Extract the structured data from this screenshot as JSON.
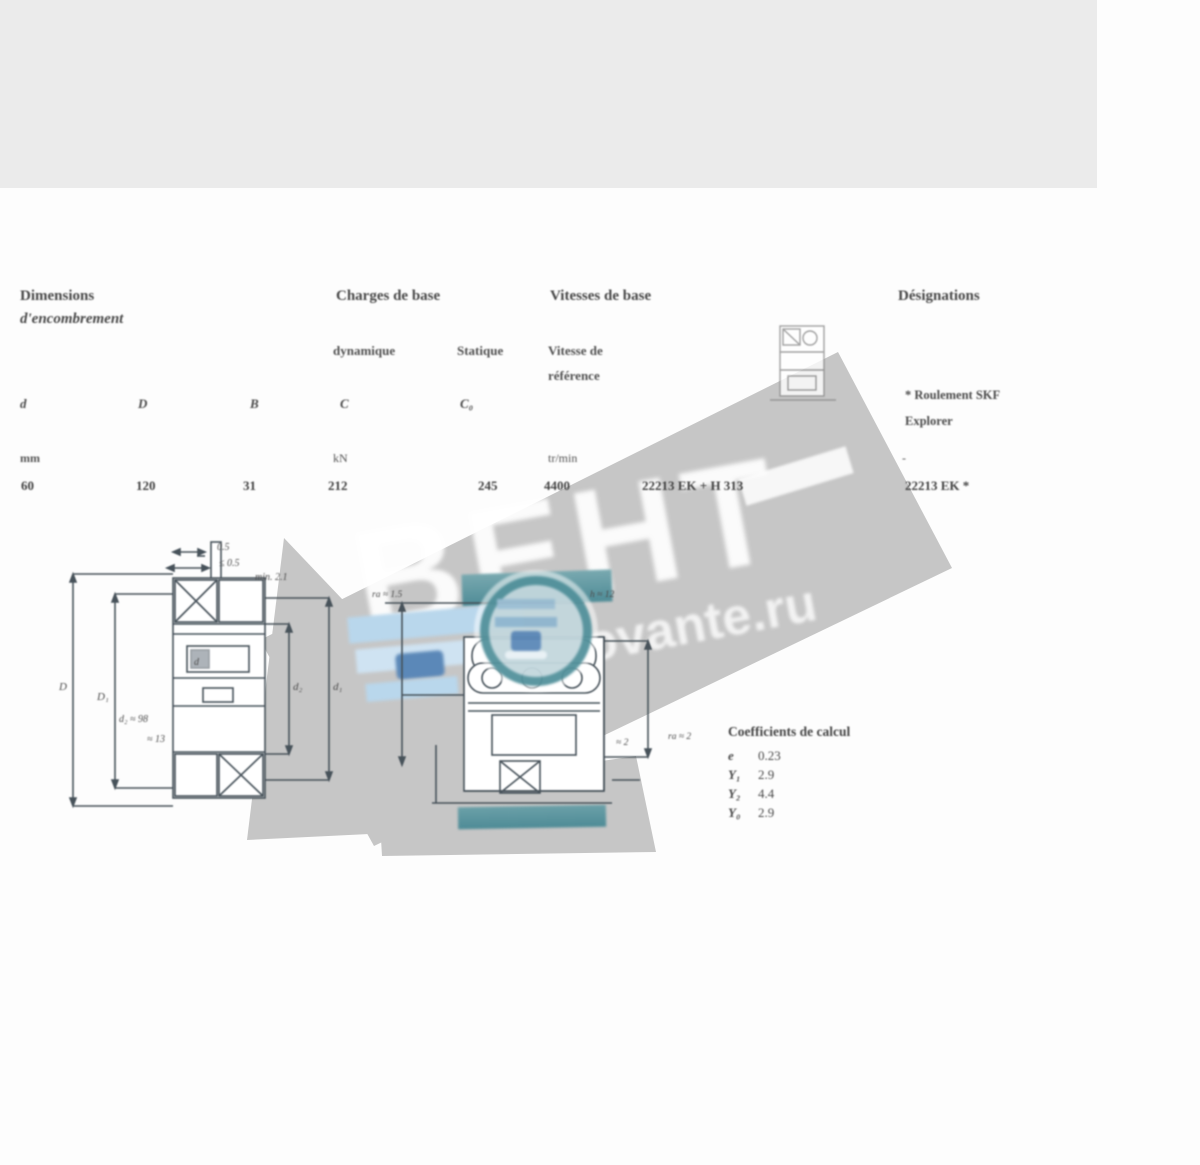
{
  "table": {
    "header": {
      "dim1": "Dimensions",
      "dim2": "d'encombrement",
      "loads": "Charges de base",
      "speeds": "Vitesses de base",
      "desig": "Désignations"
    },
    "sub": {
      "dyn": "dynamique",
      "stat": "Statique",
      "ref1": "Vitesse de",
      "ref2": "référence"
    },
    "sym": {
      "d": "d",
      "D": "D",
      "B": "B",
      "C": "C",
      "C0": "C₀"
    },
    "units": {
      "mm": "mm",
      "kn": "kN",
      "rpm": "tr/min",
      "dash": "-"
    },
    "row": {
      "d": "60",
      "D": "120",
      "B": "31",
      "C": "212",
      "C0": "245",
      "speed": "4400",
      "desig_full": "22213 EK + H 313",
      "desig": "22213 EK *"
    },
    "note1": "* Roulement SKF",
    "note2": "Explorer"
  },
  "factors": {
    "title": "Coefficients de calcul",
    "rows": [
      {
        "sym": "e",
        "val": "0.23"
      },
      {
        "sym": "Y₁",
        "val": "2.9"
      },
      {
        "sym": "Y₂",
        "val": "4.4"
      },
      {
        "sym": "Y₀",
        "val": "2.9"
      }
    ]
  },
  "watermark": {
    "brand": "ВЕНТ",
    "site": "movante.ru"
  },
  "drawings": {
    "left": {
      "top1": "0.5",
      "top2": "≤ 0.5",
      "top3": "min. 2.1",
      "l1": "D",
      "l2": "D₁",
      "r1": "d₂",
      "r2": "d₁",
      "b1": "d₂ ≈ 98",
      "b2": "≈ 13",
      "bore": "d"
    },
    "right": {
      "l1": "ra ≈ 1.5",
      "r1": "h ≈ 12",
      "r2": "≈ 2",
      "b1": "ra ≈ 2"
    }
  }
}
